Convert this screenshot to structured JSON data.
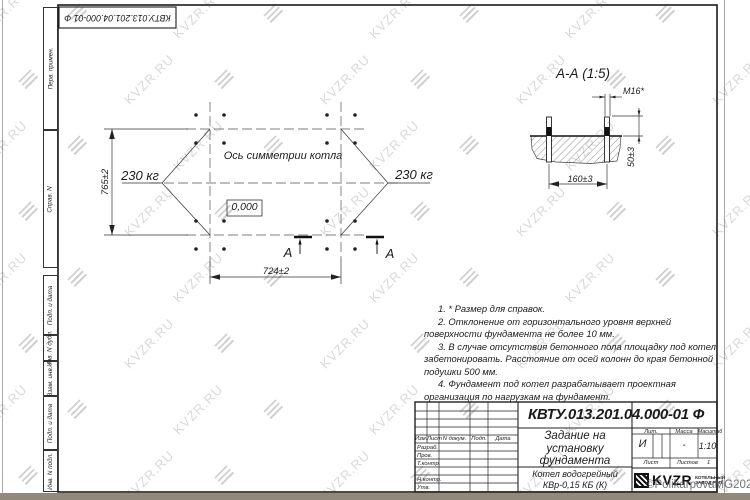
{
  "sheet": {
    "top_stamp": "КВТУ.013.201.04.000-01 Ф",
    "left_strip": [
      "Перв. примен.",
      "Справ. N",
      "Подп. и дата",
      "Инв. N дубл.",
      "Взам. инв. N",
      "Подп. и дата",
      "Инв. N подл."
    ]
  },
  "plan": {
    "symmetry_axis_label": "Ось симметрии котла",
    "load_left": "230 кг",
    "load_right": "230 кг",
    "elevation_mark": "0,000",
    "dim_height": "765±2",
    "dim_width": "724±2",
    "section_mark_left": "А",
    "section_mark_right": "А"
  },
  "section_view": {
    "title": "А-А (1:5)",
    "bolt_thread": "М16*",
    "dim_bolt_spacing": "160±3",
    "dim_bolt_height": "50±3"
  },
  "notes": [
    "1. * Размер для справок.",
    "2. Отклонение от горизонтального уровня верхней поверхности фундамента не более 10 мм.",
    "3. В случае отсутствия бетонного пола площадку под котел забетонировать. Расстояние от осей колонн до края бетонной подушки 500 мм.",
    "4. Фундамент под котел разрабатывает проектная организация по нагрузкам на фундамент."
  ],
  "title_block": {
    "doc_number": "КВТУ.013.201.04.000-01 Ф",
    "title_lines": [
      "Задание на",
      "установку",
      "фундамента"
    ],
    "product_lines": [
      "Котел водогрейный",
      "КВр-0,15 КБ (К)"
    ],
    "col_headers": {
      "izm": "Изм.",
      "list": "Лист",
      "ndoc": "N докум.",
      "podp": "Подп.",
      "data": "Дата"
    },
    "row_labels": {
      "razrab": "Разраб.",
      "prov": "Пров.",
      "tcontr": "Т.контр.",
      "ncontr": "Н.контр.",
      "utv": "Утв."
    },
    "lit_label": "Лит.",
    "mass_label": "Масса",
    "scale_label": "Масштаб",
    "lit_value": "И",
    "mass_value": "-",
    "scale_value": "1:10",
    "sheet_label": "Лист",
    "sheets_label": "Листов",
    "sheets_value": "1",
    "logo_text": "KVZR",
    "logo_sub1": "КОТЕЛЬНЫЙ",
    "logo_sub2": "ЗАВОД РЭП"
  },
  "watermark": {
    "text": "KVZR.RU",
    "copyright": "©PolikarpovaMG2021"
  },
  "colors": {
    "line": "#1c1c1c",
    "paper": "#ffffff",
    "watermark_gray": "#c8c8c8"
  }
}
